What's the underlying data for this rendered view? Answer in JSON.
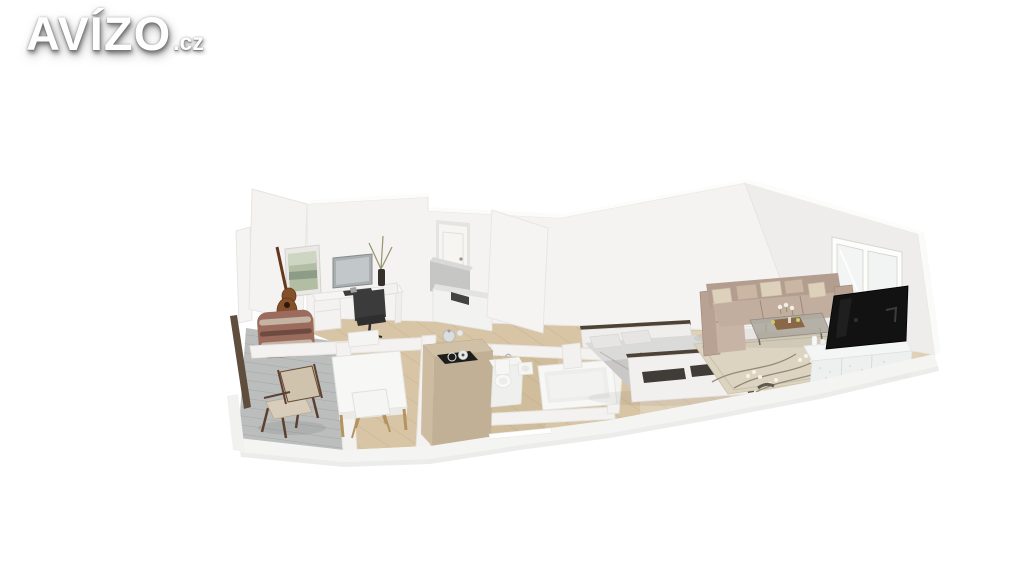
{
  "logo": {
    "brand": "AVÍZO",
    "tld": ".cz"
  },
  "scene": {
    "type": "3d-apartment-floor-plan-render",
    "rooms": [
      {
        "name": "balcony",
        "items": [
          "wooden-armchair",
          "plank-floor",
          "railing"
        ]
      },
      {
        "name": "study",
        "items": [
          "desk",
          "monitor",
          "keyboard",
          "office-chair",
          "guitar",
          "wall-art",
          "patterned-pouf",
          "dried-plant-vase"
        ]
      },
      {
        "name": "dining-area",
        "items": [
          "square-table",
          "white-chair-north",
          "white-chair-south"
        ]
      },
      {
        "name": "kitchen",
        "items": [
          "island-with-cooktop",
          "kettle",
          "counter-unit",
          "sink-cabinet",
          "entry-door"
        ]
      },
      {
        "name": "bathroom",
        "items": [
          "toilet",
          "washbasin",
          "bathtub"
        ]
      },
      {
        "name": "bedroom",
        "items": [
          "double-bed",
          "headboard",
          "footboard-cushions",
          "nightstand"
        ]
      },
      {
        "name": "living-room",
        "items": [
          "corner-sofa",
          "throw-pillows",
          "coffee-table",
          "floral-rug",
          "tv",
          "tv-stand",
          "window"
        ]
      }
    ]
  },
  "colors": {
    "background": "#ffffff",
    "wall": "#f4f3f1",
    "wall_shade": "#eeedeb",
    "wood_floor": "#d8c5a6",
    "balcony_floor": "#bcbebe",
    "railing": "#5f4e3e",
    "island": "#c2b096",
    "sofa": "#b39d8f",
    "cushion": "#ddd1bc",
    "tv": "#121212",
    "tv_stand": "#eef0f0",
    "bed_frame": "#4e4237",
    "bedding": "#c9c8c6",
    "rug": "#dcd4c1",
    "guitar": "#84502a",
    "pouf": "#9b6c5e",
    "door": "#f6f5f2",
    "table": "#f7f7f5",
    "counter_grey": "#c6c7c5"
  }
}
